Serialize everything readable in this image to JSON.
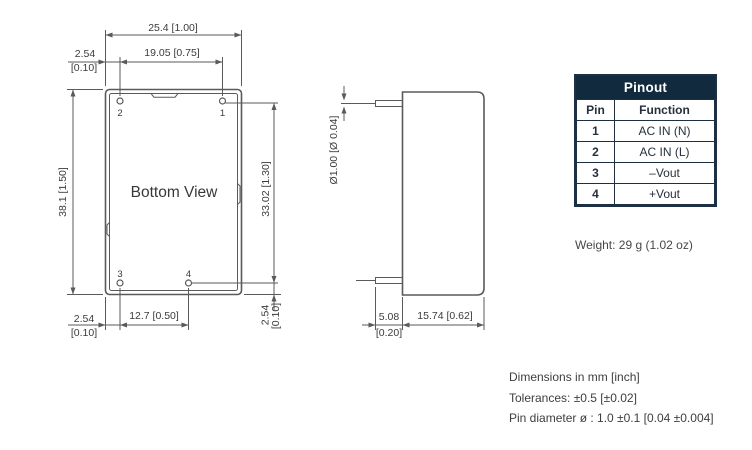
{
  "colors": {
    "header_bg": "#112a3e",
    "table_border": "#1c2f43",
    "table_text": "#26303d",
    "line": "#5a5a5a",
    "text": "#3b3b3b"
  },
  "drawing": {
    "bottom_view": {
      "title": "Bottom View",
      "pin_labels": {
        "p1": "1",
        "p2": "2",
        "p3": "3",
        "p4": "4"
      },
      "dims": {
        "overall_width": "25.4 [1.00]",
        "pin_pitch_top": "19.05 [0.75]",
        "edge_offset_mm": "2.54",
        "edge_offset_in": "[0.10]",
        "overall_height": "38.1 [1.50]",
        "pin_pitch_vertical": "33.02 [1.30]",
        "pin_pitch_bottom": "12.7 [0.50]"
      }
    },
    "side_view": {
      "dims": {
        "pin_diameter": "Ø1.00 [Ø 0.04]",
        "pin_length_mm": "5.08",
        "pin_length_in": "[0.20]",
        "body_depth": "15.74 [0.62]"
      }
    }
  },
  "pinout": {
    "title": "Pinout",
    "columns": {
      "pin": "Pin",
      "function": "Function"
    },
    "rows": [
      {
        "pin": "1",
        "function": "AC IN (N)"
      },
      {
        "pin": "2",
        "function": "AC IN (L)"
      },
      {
        "pin": "3",
        "function": "–Vout"
      },
      {
        "pin": "4",
        "function": "+Vout"
      }
    ]
  },
  "weight": "Weight: 29 g (1.02 oz)",
  "notes": {
    "line1": "Dimensions in mm [inch]",
    "line2": "Tolerances: ±0.5 [±0.02]",
    "line3": "Pin diameter ø : 1.0 ±0.1 [0.04 ±0.004]"
  }
}
